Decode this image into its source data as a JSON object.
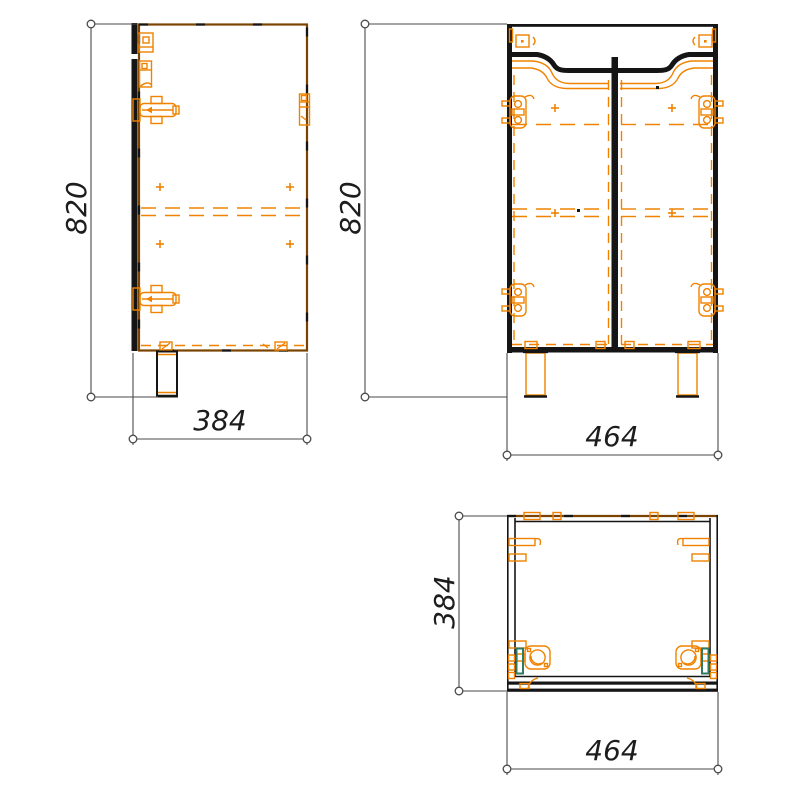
{
  "drawing": {
    "title": "Vanity cabinet three-view technical drawing",
    "views": {
      "side": {
        "name": "side-view"
      },
      "front": {
        "name": "front-view"
      },
      "plan": {
        "name": "top-view"
      }
    }
  },
  "dims": {
    "side_height": "820",
    "side_depth": "384",
    "front_height": "820",
    "front_width": "464",
    "plan_depth": "384",
    "plan_width": "464"
  },
  "colors": {
    "fitting_orange": "#F08200",
    "hidden_brown": "#7A4300",
    "line_black": "#151515",
    "dimension_gray": "#4A4A4A",
    "accent_teal": "#2E7A63",
    "background": "#FFFFFF"
  },
  "icons": {
    "side_hinge": "hinge-side-icon",
    "front_hinge": "hinge-front-icon",
    "plan_hinge_cup": "hinge-cup-icon",
    "leg": "leg-icon",
    "dimension_terminator": "circle-terminator-icon",
    "cross_mark": "drill-cross-icon"
  }
}
